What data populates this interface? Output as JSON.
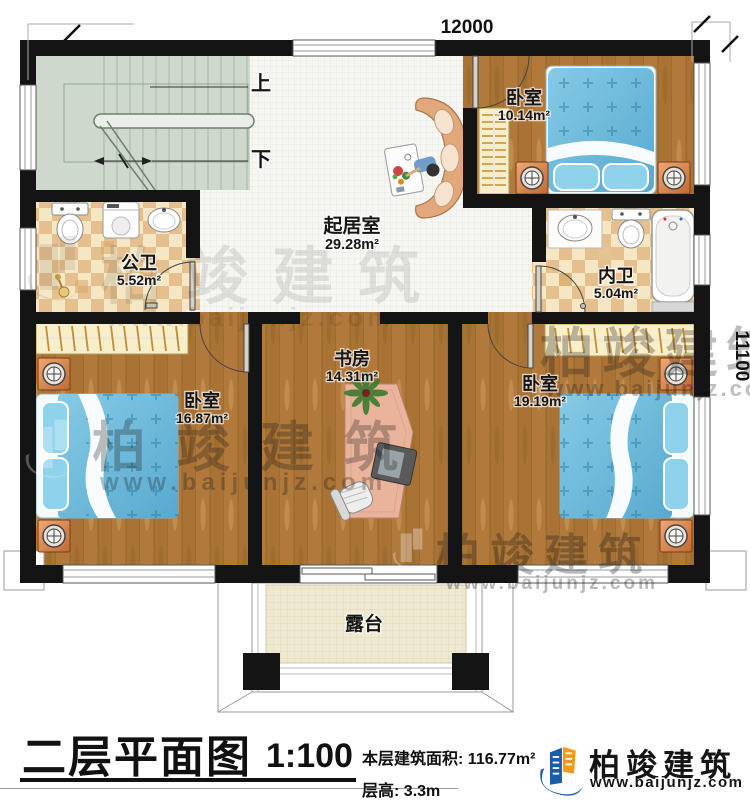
{
  "plan": {
    "dimension_top": "12000",
    "dimension_right": "11100",
    "stairs": {
      "up": "上",
      "down": "下"
    },
    "rooms": {
      "living": {
        "name": "起居室",
        "area": "29.28m²"
      },
      "bedroom_top": {
        "name": "卧室",
        "area": "10.14m²"
      },
      "bath_public": {
        "name": "公卫",
        "area": "5.52m²"
      },
      "bath_private": {
        "name": "内卫",
        "area": "5.04m²"
      },
      "bedroom_left": {
        "name": "卧室",
        "area": "16.87m²"
      },
      "study": {
        "name": "书房",
        "area": "14.31m²"
      },
      "bedroom_right": {
        "name": "卧室",
        "area": "19.19m²"
      },
      "terrace": {
        "name": "露台"
      }
    }
  },
  "titleblock": {
    "title": "二层平面图",
    "scale": "1:100",
    "area_label": "本层建筑面积:",
    "area_value": "116.77m²",
    "height_label": "层高:",
    "height_value": "3.3m"
  },
  "brand": {
    "name": "柏竣建筑",
    "url": "www.baijunjz.com",
    "blue": "#1b5ca8",
    "orange": "#f29a1c"
  },
  "watermark": {
    "name": "柏竣建筑",
    "url": "www.baijunjz.com"
  }
}
